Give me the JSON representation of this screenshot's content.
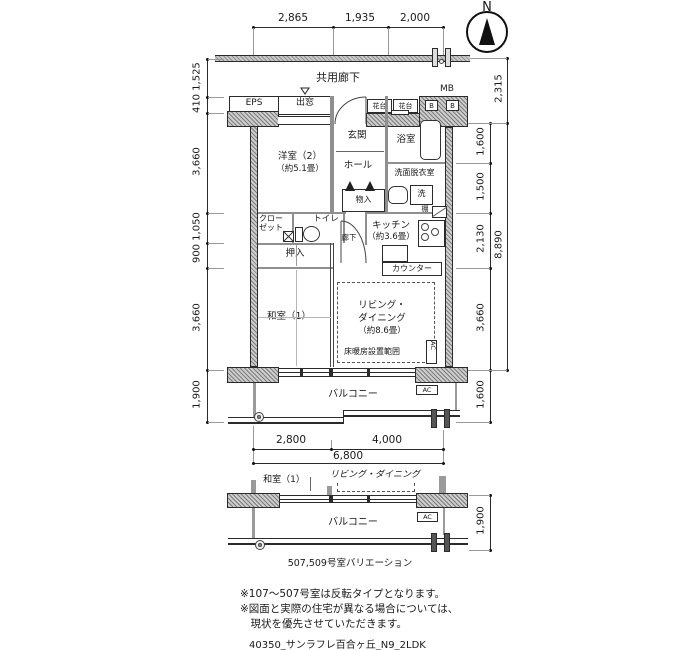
{
  "north": {
    "label": "N"
  },
  "dims": {
    "top": [
      "2,865",
      "1,935",
      "2,000"
    ],
    "left": [
      "1,525",
      "410",
      "3,660",
      "1,050",
      "900",
      "3,660",
      "1,900"
    ],
    "right_inner": [
      "1,600",
      "1,500",
      "2,130",
      "3,660",
      "1,600"
    ],
    "right_outer_top": "2,315",
    "right_outer_total": "8,890",
    "bottom_segments": [
      "2,800",
      "4,000"
    ],
    "bottom_total": "6,800"
  },
  "labels": {
    "corridor": "共用廊下",
    "eps": "EPS",
    "bay_window": "出窓",
    "flower_stand_1": "花台",
    "flower_stand_2": "花台",
    "meter_box": "MB",
    "meter_b_1": "B",
    "meter_b_2": "B",
    "entrance": "玄関",
    "hall": "ホール",
    "bathroom": "浴室",
    "washroom": "洗面脱衣室",
    "washer": "洗",
    "storage": "物入",
    "closet_line1": "クロー",
    "closet_line2": "ゼット",
    "toilet": "トイレ",
    "corridor_inner": "廊下",
    "western_room": "洋室（2）",
    "western_room_size": "（約5.1畳）",
    "kitchen": "キッチン",
    "kitchen_size": "（約3.6畳）",
    "shelf": "棚",
    "counter": "カウンター",
    "oshiire": "押入",
    "japanese_room": "和室（1）",
    "living_line1": "リビング・",
    "living_line2": "ダイニング",
    "living_size": "（約8.6畳）",
    "floor_heating": "床暖房設置範囲",
    "ac_living": "AC",
    "balcony": "バルコニー",
    "ac_balcony": "AC"
  },
  "variation": {
    "japanese_room": "和室（1）",
    "living": "リビング・ダイニング",
    "balcony": "バルコニー",
    "ac": "AC",
    "dim_right": "1,900",
    "caption": "507,509号室バリエーション"
  },
  "notes": {
    "line1": "※107〜507号室は反転タイプとなります。",
    "line2": "※図面と実際の住宅が異なる場合については、",
    "line3": "　現状を優先させていただきます。",
    "file_code": "40350_サンラフレ百合ヶ丘_N9_2LDK"
  }
}
